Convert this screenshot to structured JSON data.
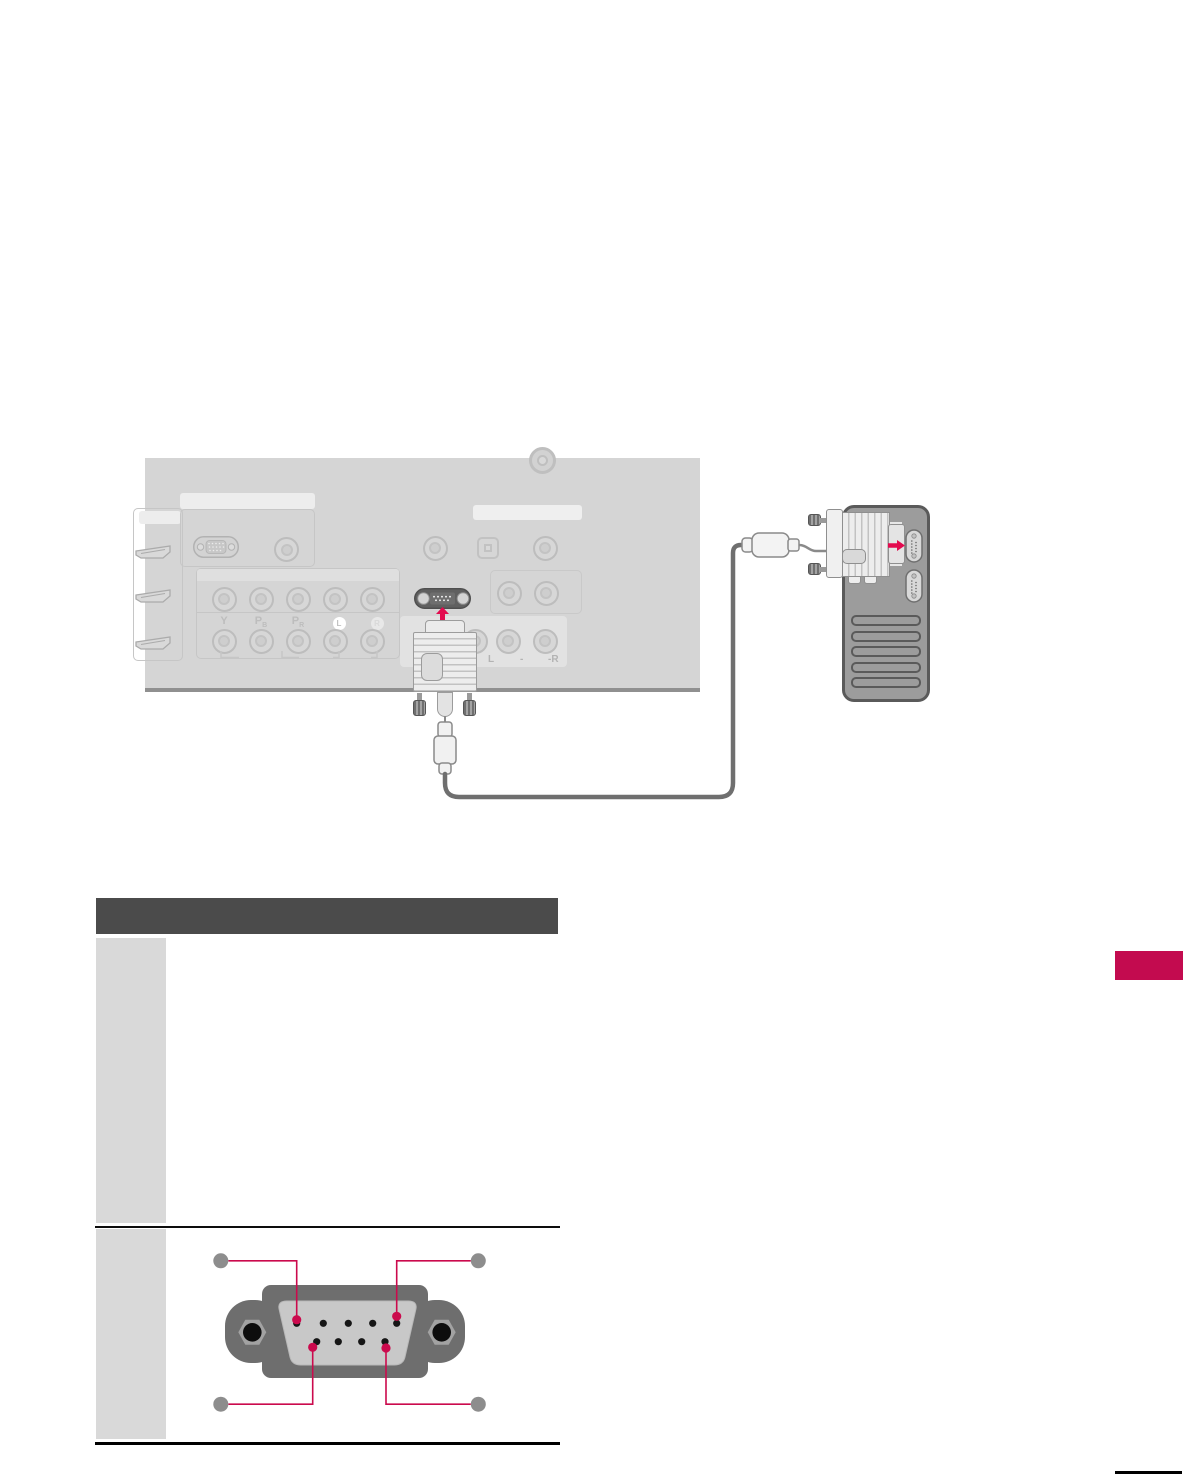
{
  "document": {
    "type": "tv-manual-page-external-control-setup",
    "background": "#ffffff"
  },
  "colors": {
    "accent_pink": "#cb0a4d",
    "arrow_pink": "#e30a4e",
    "chapter_tab_pink": "#c30b4f",
    "table_header_bar": "#4b4b4b",
    "tv_panel_gray": "#d5d5d5",
    "table_row_label_gray": "#d9d9d9",
    "pc_tower_gray": "#9c9c9c",
    "connector_body_gray": "#6e6e6e"
  },
  "connection_diagram": {
    "tv_back_panel": {
      "component_labels": [
        {
          "main": "Y",
          "sub": ""
        },
        {
          "main": "P",
          "sub": "B"
        },
        {
          "main": "P",
          "sub": "R"
        }
      ],
      "left_audio_badge": "L",
      "right_audio_badge": "R",
      "audio_jack_labels": [
        "L",
        "-",
        "-R"
      ],
      "ports": [
        "antenna-jack",
        "hdmi-ports",
        "vga-port",
        "audio-jack",
        "component-rca-jacks",
        "optical-digital-audio",
        "rs232c-port",
        "av-rca-jacks"
      ]
    },
    "pc": {
      "ports": [
        "serial-port-1",
        "serial-port-2"
      ],
      "vent_slots": 5
    },
    "cable": "rs232c-serial-cable"
  },
  "spec_table": {
    "rows": 2
  },
  "pin_diagram": {
    "connector": "d-sub-9-pin",
    "pins_top_row": 5,
    "pins_bottom_row": 4,
    "highlighted_pins": 4,
    "callouts": 4
  }
}
